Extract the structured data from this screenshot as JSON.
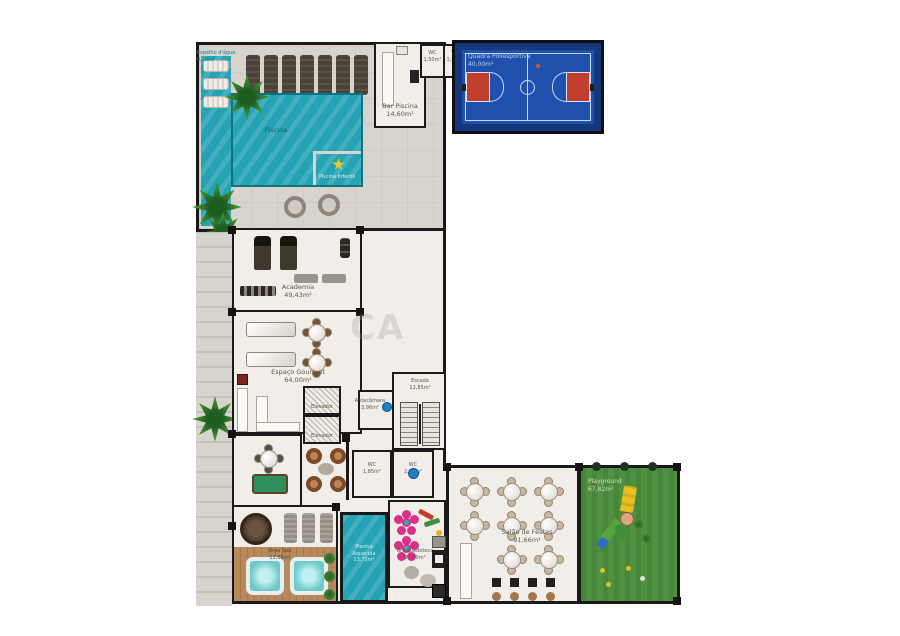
{
  "areas": {
    "espelho_dagua": {
      "name": "Espelho d'água",
      "area": "8,15m²"
    },
    "piscina": {
      "name": "Piscina"
    },
    "piscina_infantil": {
      "name": "Piscina Infantil"
    },
    "bar_piscina": {
      "name": "Bar Piscina",
      "area": "14,60m²"
    },
    "wc_top_a": {
      "name": "WC",
      "area": "1,50m²"
    },
    "wc_top_b": {
      "name": "WC",
      "area": "1,50m²"
    },
    "quadra": {
      "name": "Quadra Poliesportiva",
      "area": "40,00m²"
    },
    "academia": {
      "name": "Academia",
      "area": "49,43m²"
    },
    "espaco_gourmet": {
      "name": "Espaço Gourmet",
      "area": "64,00m²"
    },
    "elevador_a": {
      "name": "Elevador"
    },
    "elevador_b": {
      "name": "Elevador"
    },
    "antecamara": {
      "name": "Antecâmara",
      "area": "3,96m²"
    },
    "escada": {
      "name": "Escada",
      "area": "12,85m²"
    },
    "wc_a": {
      "name": "WC",
      "area": "1,85m²"
    },
    "wc_b": {
      "name": "WC",
      "area": "2,25m²"
    },
    "sala_jogos": {
      "name": "Sala de Jogos",
      "area": "32,62m²"
    },
    "area_spa": {
      "name": "Área Spa",
      "area": "12,65m²"
    },
    "piscina_aquecida": {
      "l1": "Piscina",
      "l2": "Aquecida",
      "l3": "13,75m²"
    },
    "brinquedoteca": {
      "name": "Brinquedoteca",
      "area": "27,00m²"
    },
    "salao_festas": {
      "name": "Salão de Festas",
      "area": "91,66m²"
    },
    "playground": {
      "name": "Playground",
      "area": "67,82m²"
    }
  },
  "watermark": "CA",
  "colors": {
    "water": "#25a3b4",
    "court_blue": "#2050ae",
    "court_frame": "#16377c",
    "key_red": "#c23e2e",
    "grass": "#4e9140",
    "wood": "#b9895a",
    "deck": "#d8d4cd",
    "floor": "#f1eee9",
    "wall": "#1a1a1a"
  }
}
